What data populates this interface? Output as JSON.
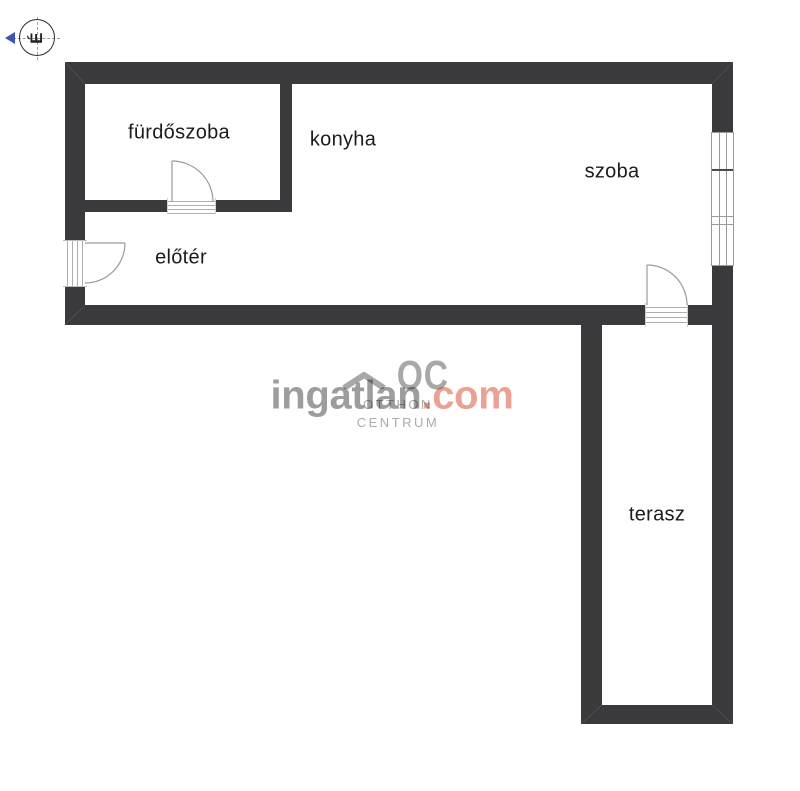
{
  "plan": {
    "background": "#ffffff",
    "wall_color": "#3a3a3c",
    "line_color": "#9b9b9b",
    "label_color": "#1c1c1c"
  },
  "compass": {
    "north_letter": "É",
    "arrow_color": "#3d55b5"
  },
  "rooms": {
    "furdoszoba": {
      "label": "fürdőszoba"
    },
    "konyha": {
      "label": "konyha"
    },
    "szoba": {
      "label": "szoba"
    },
    "eloter": {
      "label": "előtér"
    },
    "terasz": {
      "label": "terasz"
    }
  },
  "watermark": {
    "brand_name": "ingatlan",
    "brand_tld": ".com",
    "brand_name_color": "#9d9d9d",
    "brand_tld_color": "#eca195",
    "logo_monogram": "OC",
    "logo_caption_line1": "OTTHON",
    "logo_caption_line2": "CENTRUM",
    "logo_color": "#a8a8a8"
  }
}
